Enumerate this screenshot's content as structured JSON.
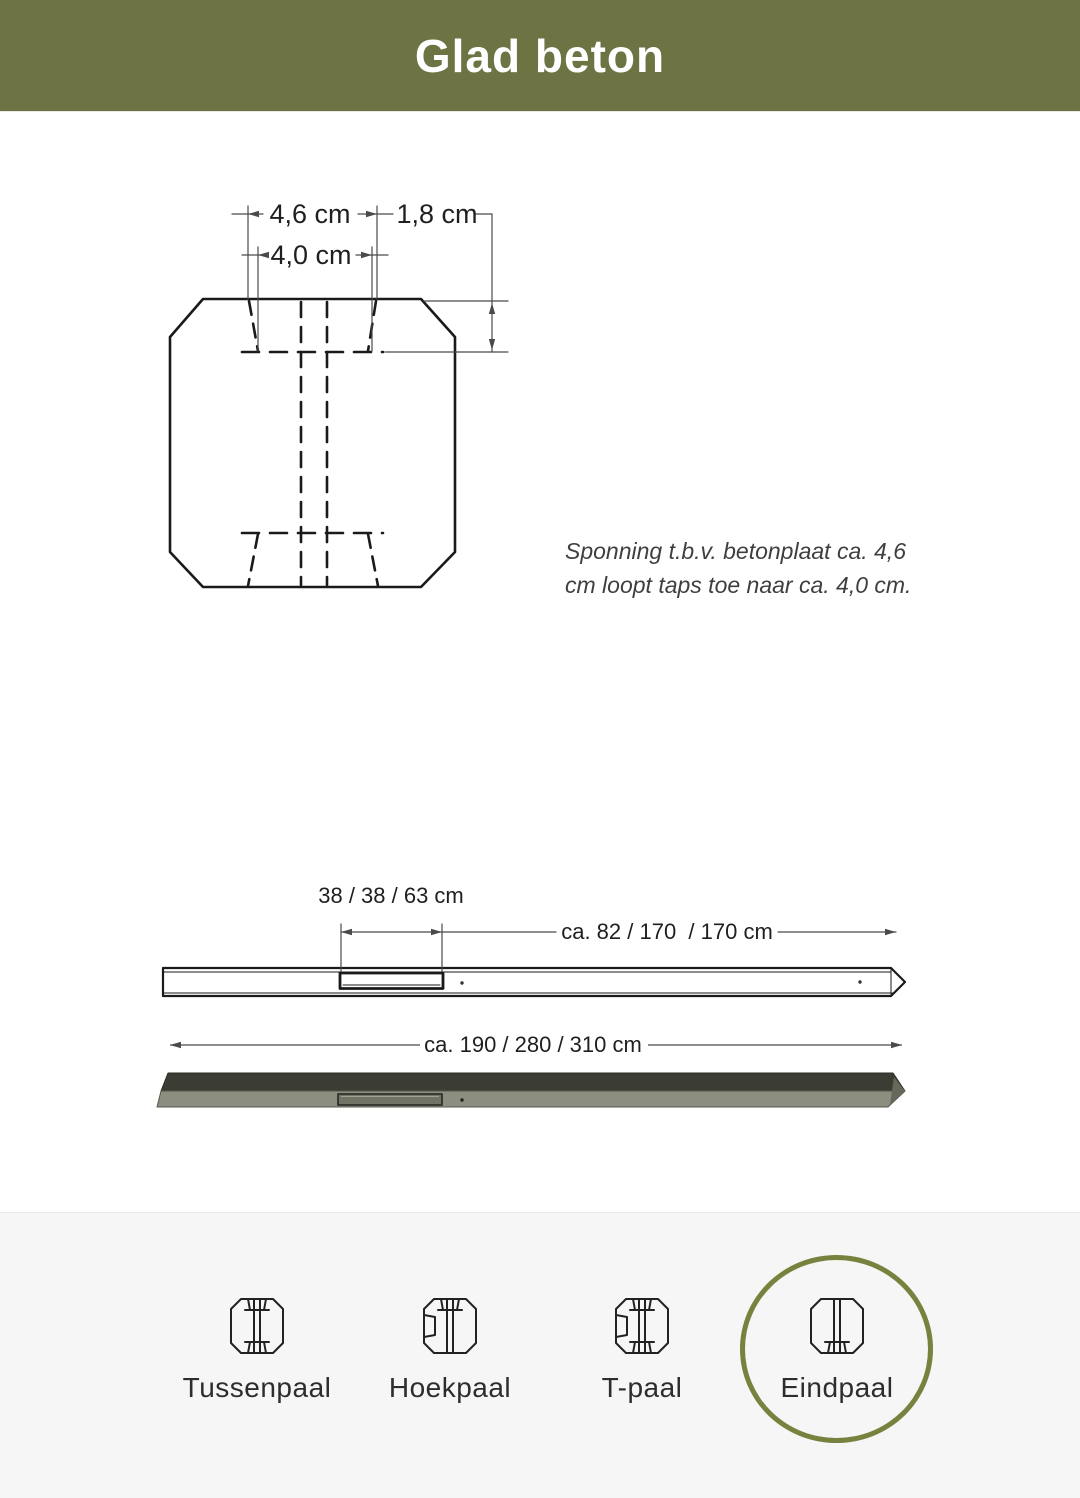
{
  "header": {
    "title": "Glad beton"
  },
  "colors": {
    "header_bg": "#6d7343",
    "highlight_circle": "#78823f",
    "panel_bg": "#f6f6f6",
    "post_top_face": "#3b3d35",
    "post_front_face": "#8c8e80"
  },
  "cross_section": {
    "dim_top_width": "4,6 cm",
    "dim_depth": "1,8 cm",
    "dim_bottom_width": "4,0 cm",
    "note_line1": "Sponning t.b.v. betonplaat ca. 4,6",
    "note_line2": "cm loopt taps toe naar ca. 4,0 cm."
  },
  "length_diagram": {
    "dim_recess": "38 / 38 / 63 cm",
    "dim_upper_section": "ca. 82 / 170  / 170 cm",
    "dim_total": "ca. 190 / 280 / 310 cm"
  },
  "post_types": {
    "highlighted": "Eindpaal",
    "items": [
      {
        "label": "Tussenpaal"
      },
      {
        "label": "Hoekpaal"
      },
      {
        "label": "T-paal"
      },
      {
        "label": "Eindpaal"
      }
    ]
  }
}
